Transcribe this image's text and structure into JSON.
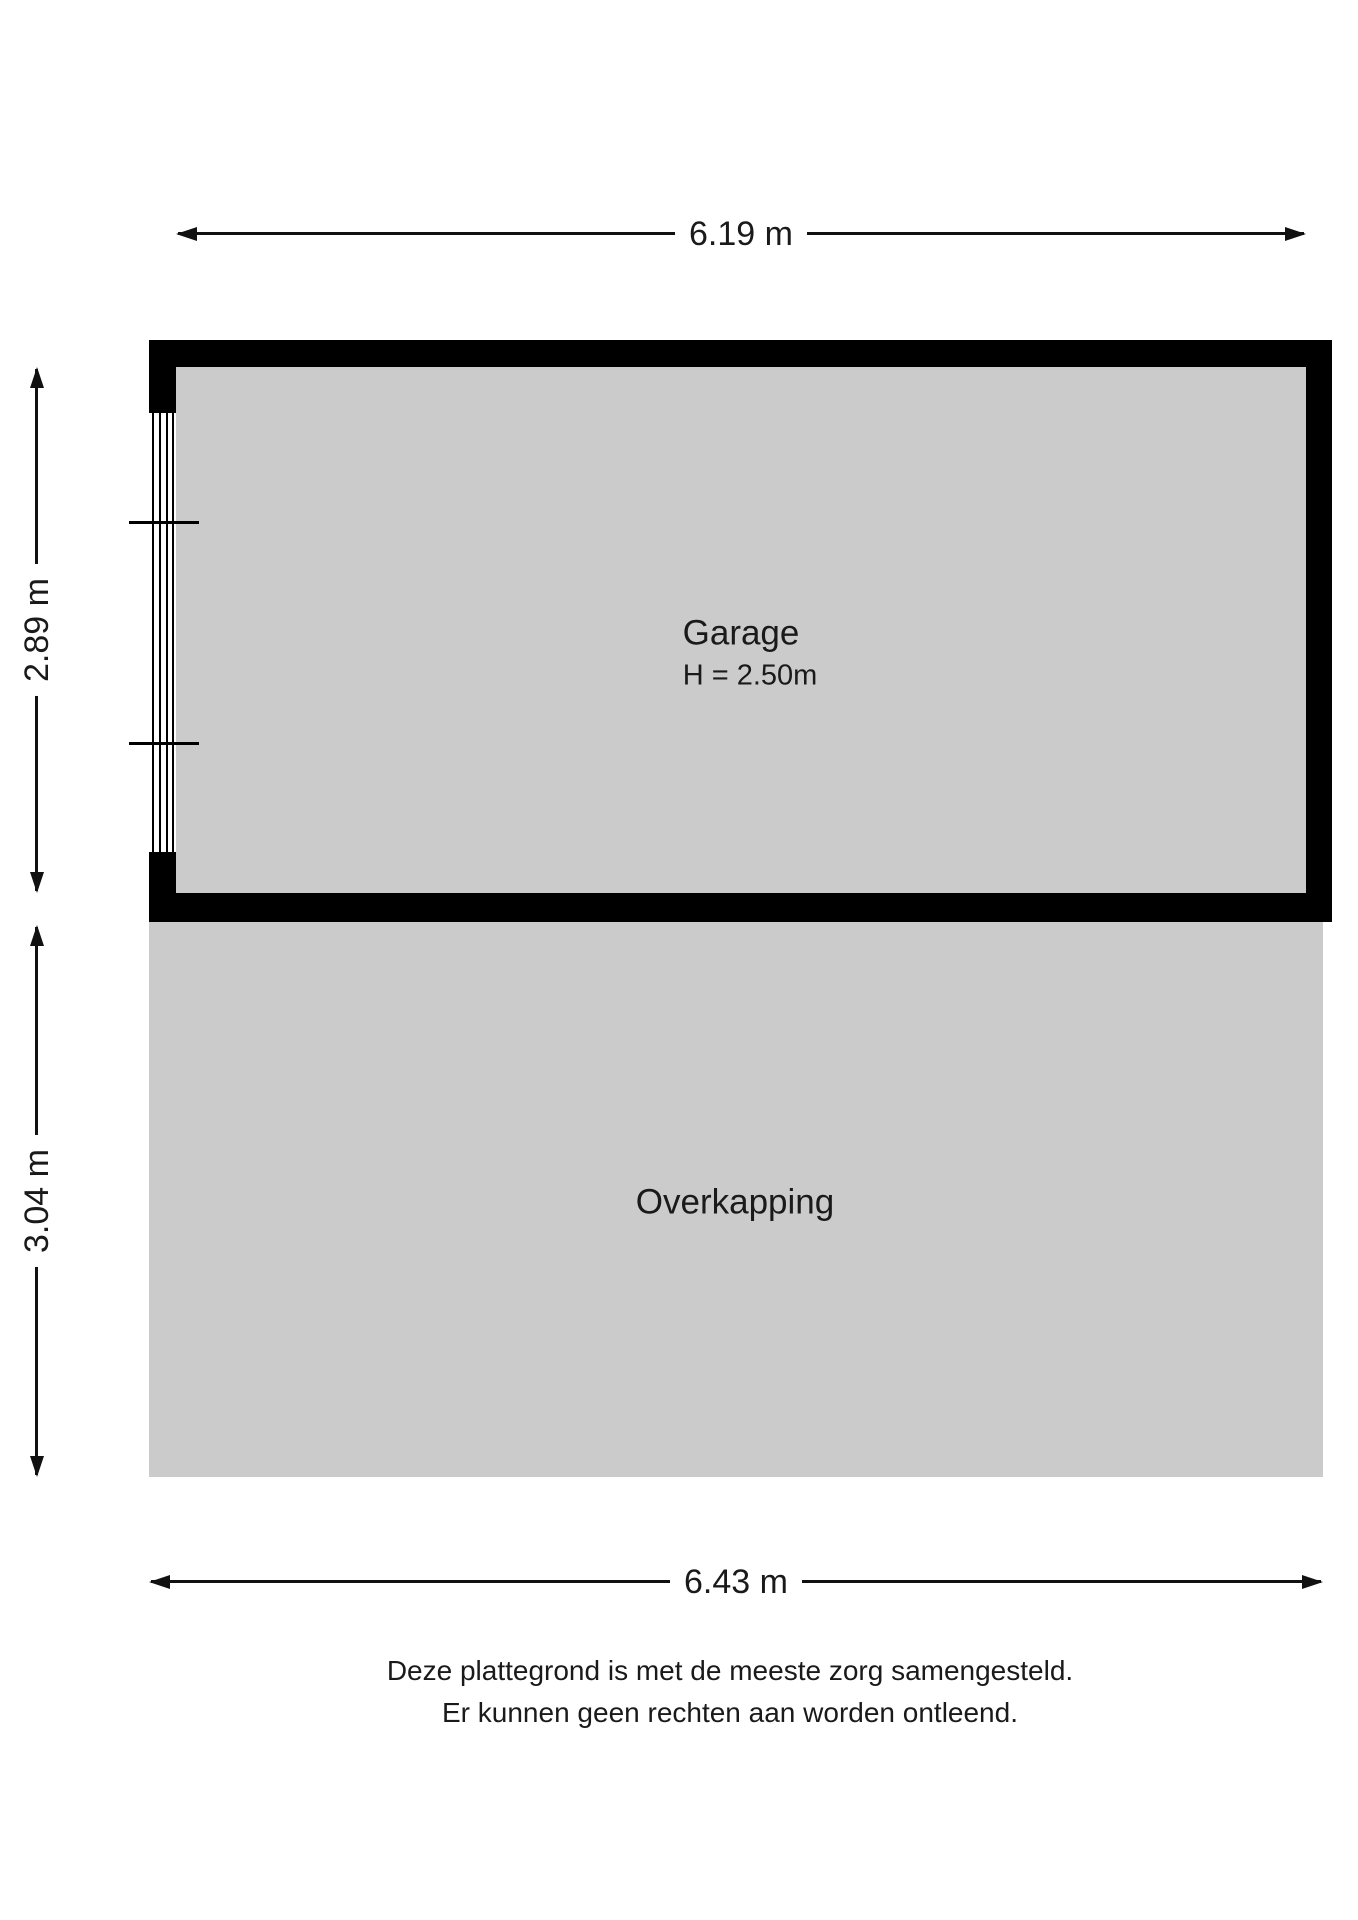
{
  "plan": {
    "garage": {
      "name": "Garage",
      "ceiling_height": "H = 2.50m"
    },
    "overkapping": {
      "name": "Overkapping"
    },
    "dimensions": {
      "top_width": "6.19 m",
      "garage_depth": "2.89 m",
      "overkapping_depth": "3.04 m",
      "bottom_width": "6.43 m"
    },
    "colors": {
      "floor_fill": "#cbcbcb",
      "wall": "#000000"
    },
    "icons": {
      "arrowhead": "solid black triangle (dimension arrow end)",
      "window": "four parallel lines in wall opening with two tick marks"
    }
  },
  "footer": {
    "line1": "Deze plattegrond is met de meeste zorg samengesteld.",
    "line2": "Er kunnen geen rechten aan worden ontleend."
  }
}
